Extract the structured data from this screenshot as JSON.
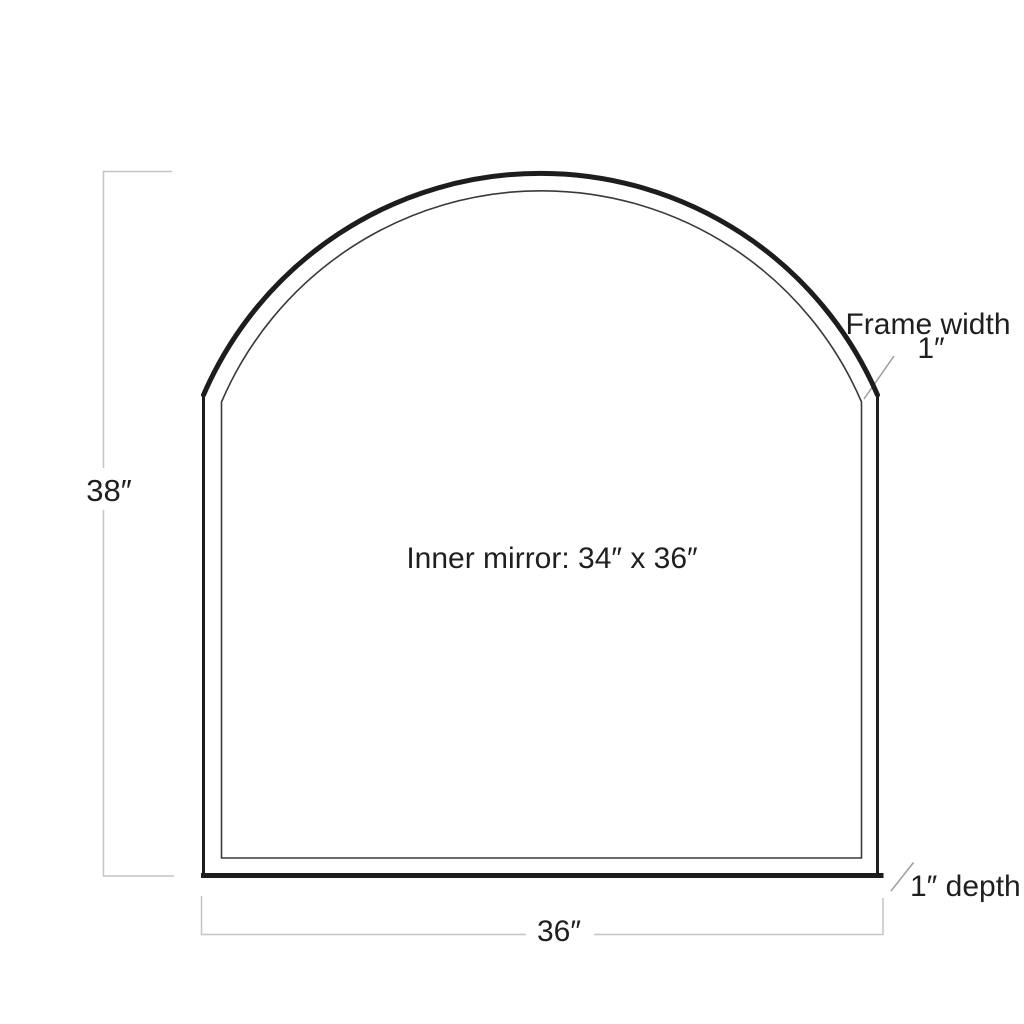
{
  "figure": {
    "labels": {
      "height_dim": "38″",
      "width_dim": "36″",
      "inner_mirror": "Inner mirror: 34″ x 36″",
      "frame_width_line1": "Frame width",
      "frame_width_line2": "1″",
      "depth": "1″ depth"
    },
    "colors": {
      "outline": "#1d1d1d",
      "inner_line": "#3a3a3a",
      "dimension_line": "#c4c4c4",
      "leader_line": "#9e9e9e",
      "text": "#1f1f1f",
      "background": "#ffffff"
    }
  }
}
